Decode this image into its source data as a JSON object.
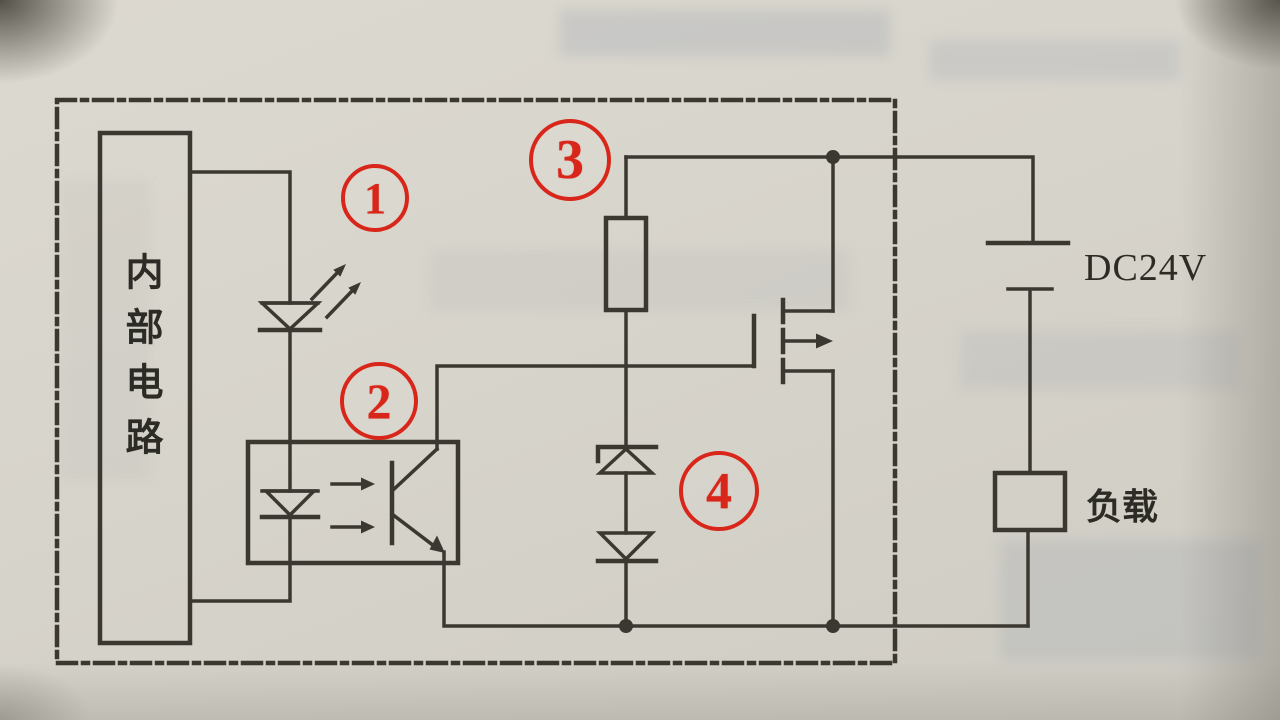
{
  "diagram": {
    "internal_circuit_label": "内部电路",
    "power_label": "DC24V",
    "load_label": "负载",
    "callouts": [
      {
        "id": 1,
        "label": "1"
      },
      {
        "id": 2,
        "label": "2"
      },
      {
        "id": 3,
        "label": "3"
      },
      {
        "id": 4,
        "label": "4"
      }
    ],
    "colors": {
      "callout_red": "#d9261a",
      "line_dark": "#3b3831",
      "page_background": "#d7d4cb"
    }
  }
}
